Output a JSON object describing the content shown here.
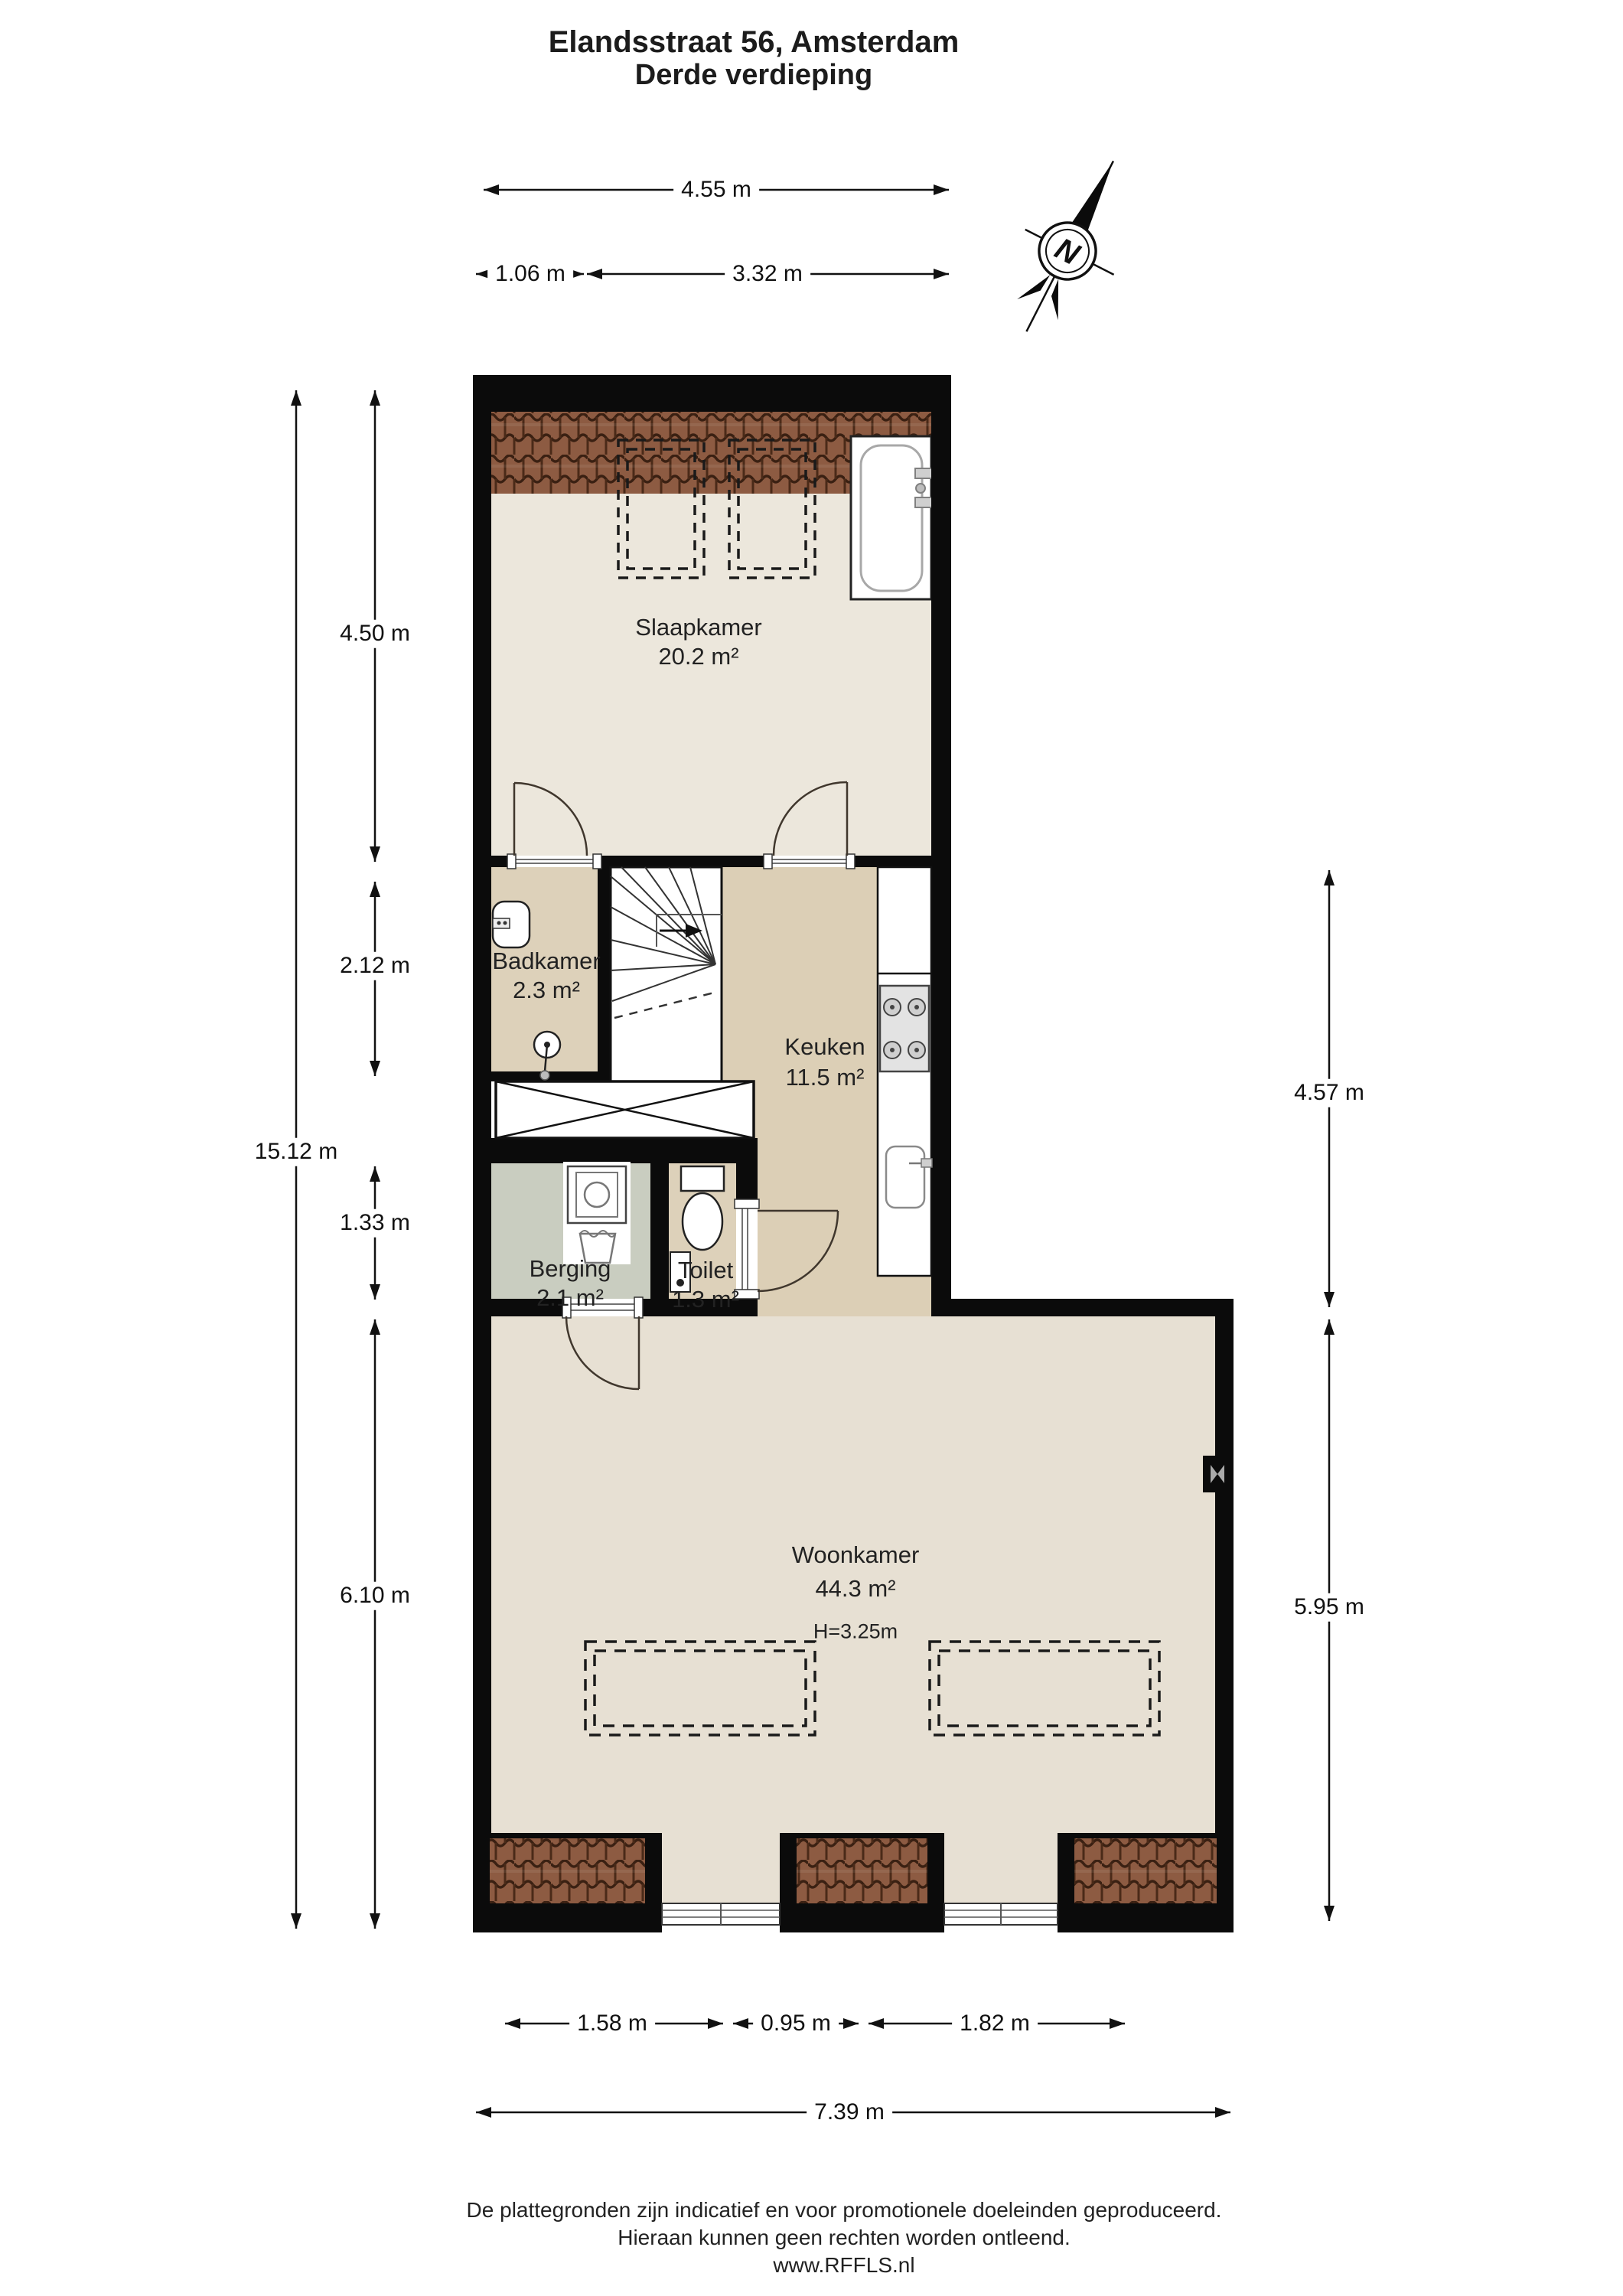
{
  "title": {
    "address": "Elandsstraat 56, Amsterdam",
    "floor": "Derde verdieping"
  },
  "compass": {
    "north_label": "N"
  },
  "rooms": [
    {
      "name": "Slaapkamer",
      "area": "20.2 m²"
    },
    {
      "name": "Badkamer",
      "area": "2.3 m²"
    },
    {
      "name": "Keuken",
      "area": "11.5 m²"
    },
    {
      "name": "Berging",
      "area": "2.1 m²"
    },
    {
      "name": "Toilet",
      "area": "1.3 m²"
    },
    {
      "name": "Woonkamer",
      "area": "44.3 m²",
      "ceiling_height": "H=3.25m"
    }
  ],
  "dimensions": {
    "top": {
      "total": "4.55 m",
      "left_part": "1.06 m",
      "right_part": "3.32 m"
    },
    "left": {
      "bedroom": "4.50 m",
      "bathroom": "2.12 m",
      "storage": "1.33 m",
      "living": "6.10 m",
      "total": "15.12 m"
    },
    "right": {
      "upper": "4.57 m",
      "lower": "5.95 m"
    },
    "bottom": {
      "left_part": "1.58 m",
      "middle_part": "0.95 m",
      "right_part": "1.82 m",
      "total": "7.39 m"
    }
  },
  "footer": {
    "line1": "De plattegronden zijn indicatief en voor promotionele doeleinden geproduceerd.",
    "line2": "Hieraan kunnen geen rechten worden ontleend.",
    "line3": "www.RFFLS.nl"
  },
  "colors": {
    "wall": "#0b0b0b",
    "roof_brick": "#8d5b42",
    "floor_bedroom": "#ece7dc",
    "floor_kitchen": "#dccfb6",
    "floor_storage": "#c9cdc0",
    "floor_living": "#e7e0d3"
  }
}
